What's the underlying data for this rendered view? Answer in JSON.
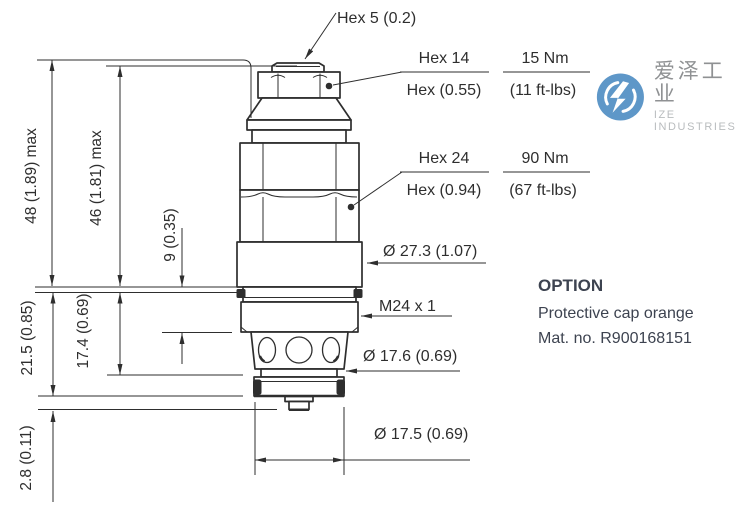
{
  "colors": {
    "line": "#2e2e2e",
    "logo_blue": "#5e97c8",
    "logo_text": "#8f9193",
    "logo_sub": "#b9bcbe",
    "option_text": "#3d4350"
  },
  "drawing": {
    "callouts": {
      "hex5": "Hex 5 (0.2)",
      "hex14_size": "Hex 14",
      "hex14_inch": "Hex (0.55)",
      "hex14_torque_nm": "15 Nm",
      "hex14_torque_ftlbs": "(11 ft-lbs)",
      "hex24_size": "Hex 24",
      "hex24_inch": "Hex (0.94)",
      "hex24_torque_nm": "90 Nm",
      "hex24_torque_ftlbs": "(67 ft-lbs)",
      "body_diameter": "Ø 27.3 (1.07)",
      "thread": "M24 x 1",
      "pilot_diameter": "Ø 17.6 (0.69)",
      "nose_diameter": "Ø 17.5 (0.69)"
    },
    "dimensions": {
      "overall_max": "48 (1.89) max",
      "body_max": "46 (1.81) max",
      "thread_length": "9 (0.35)",
      "lower_section": "17.4 (0.69)",
      "cartridge_depth": "21.5 (0.85)",
      "nose_tip": "2.8 (0.11)"
    }
  },
  "branding": {
    "name_cn": "爱泽工业",
    "name_en": "IZE INDUSTRIES"
  },
  "option": {
    "title": "OPTION",
    "description": "Protective cap orange",
    "material_no": "Mat. no. R900168151"
  }
}
